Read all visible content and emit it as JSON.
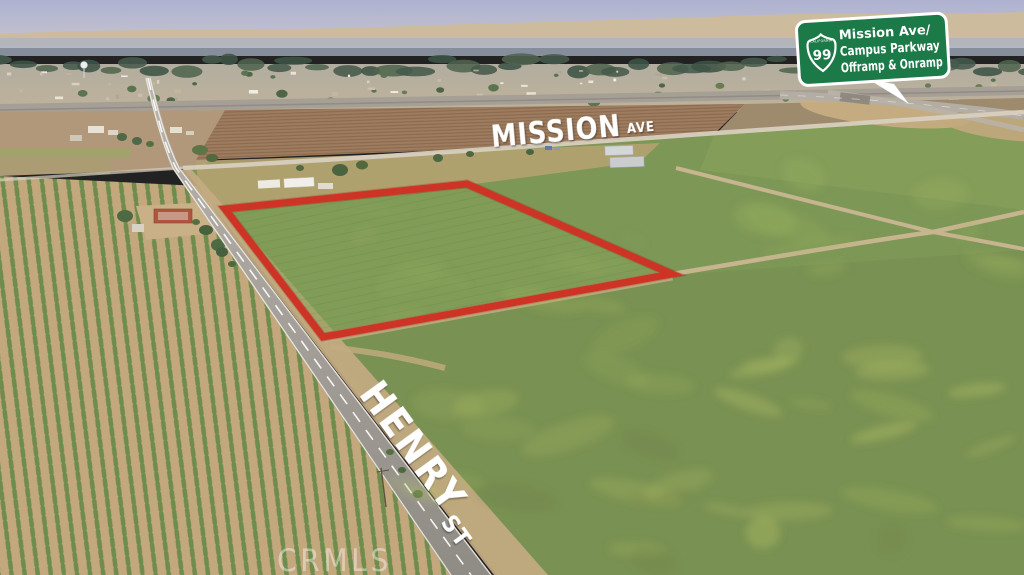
{
  "photo": {
    "description": "aerial-drone-photo-of-farmland-parcel",
    "road_labels": {
      "mission_name": "MISSION",
      "mission_suffix": "AVE",
      "henry_name": "HENRY",
      "henry_suffix": "ST"
    },
    "highway_sign": {
      "route_number": "99",
      "route_caption": "CALIFORNIA",
      "line1": "Mission Ave/",
      "line2": "Campus Parkway",
      "line3": "Offramp & Onramp",
      "sign_green": "#1b7a47",
      "text_color": "#ffffff"
    },
    "watermark": "CRMLS",
    "parcel": {
      "outline_color": "#ce3425"
    },
    "palette": {
      "sky_haze": "#aeb2d0",
      "field_green": "#7d9756",
      "orchard_tan": "#c3a77d",
      "plowed_brown": "#9d7c5f",
      "road_gray": "#a9a49c"
    }
  }
}
